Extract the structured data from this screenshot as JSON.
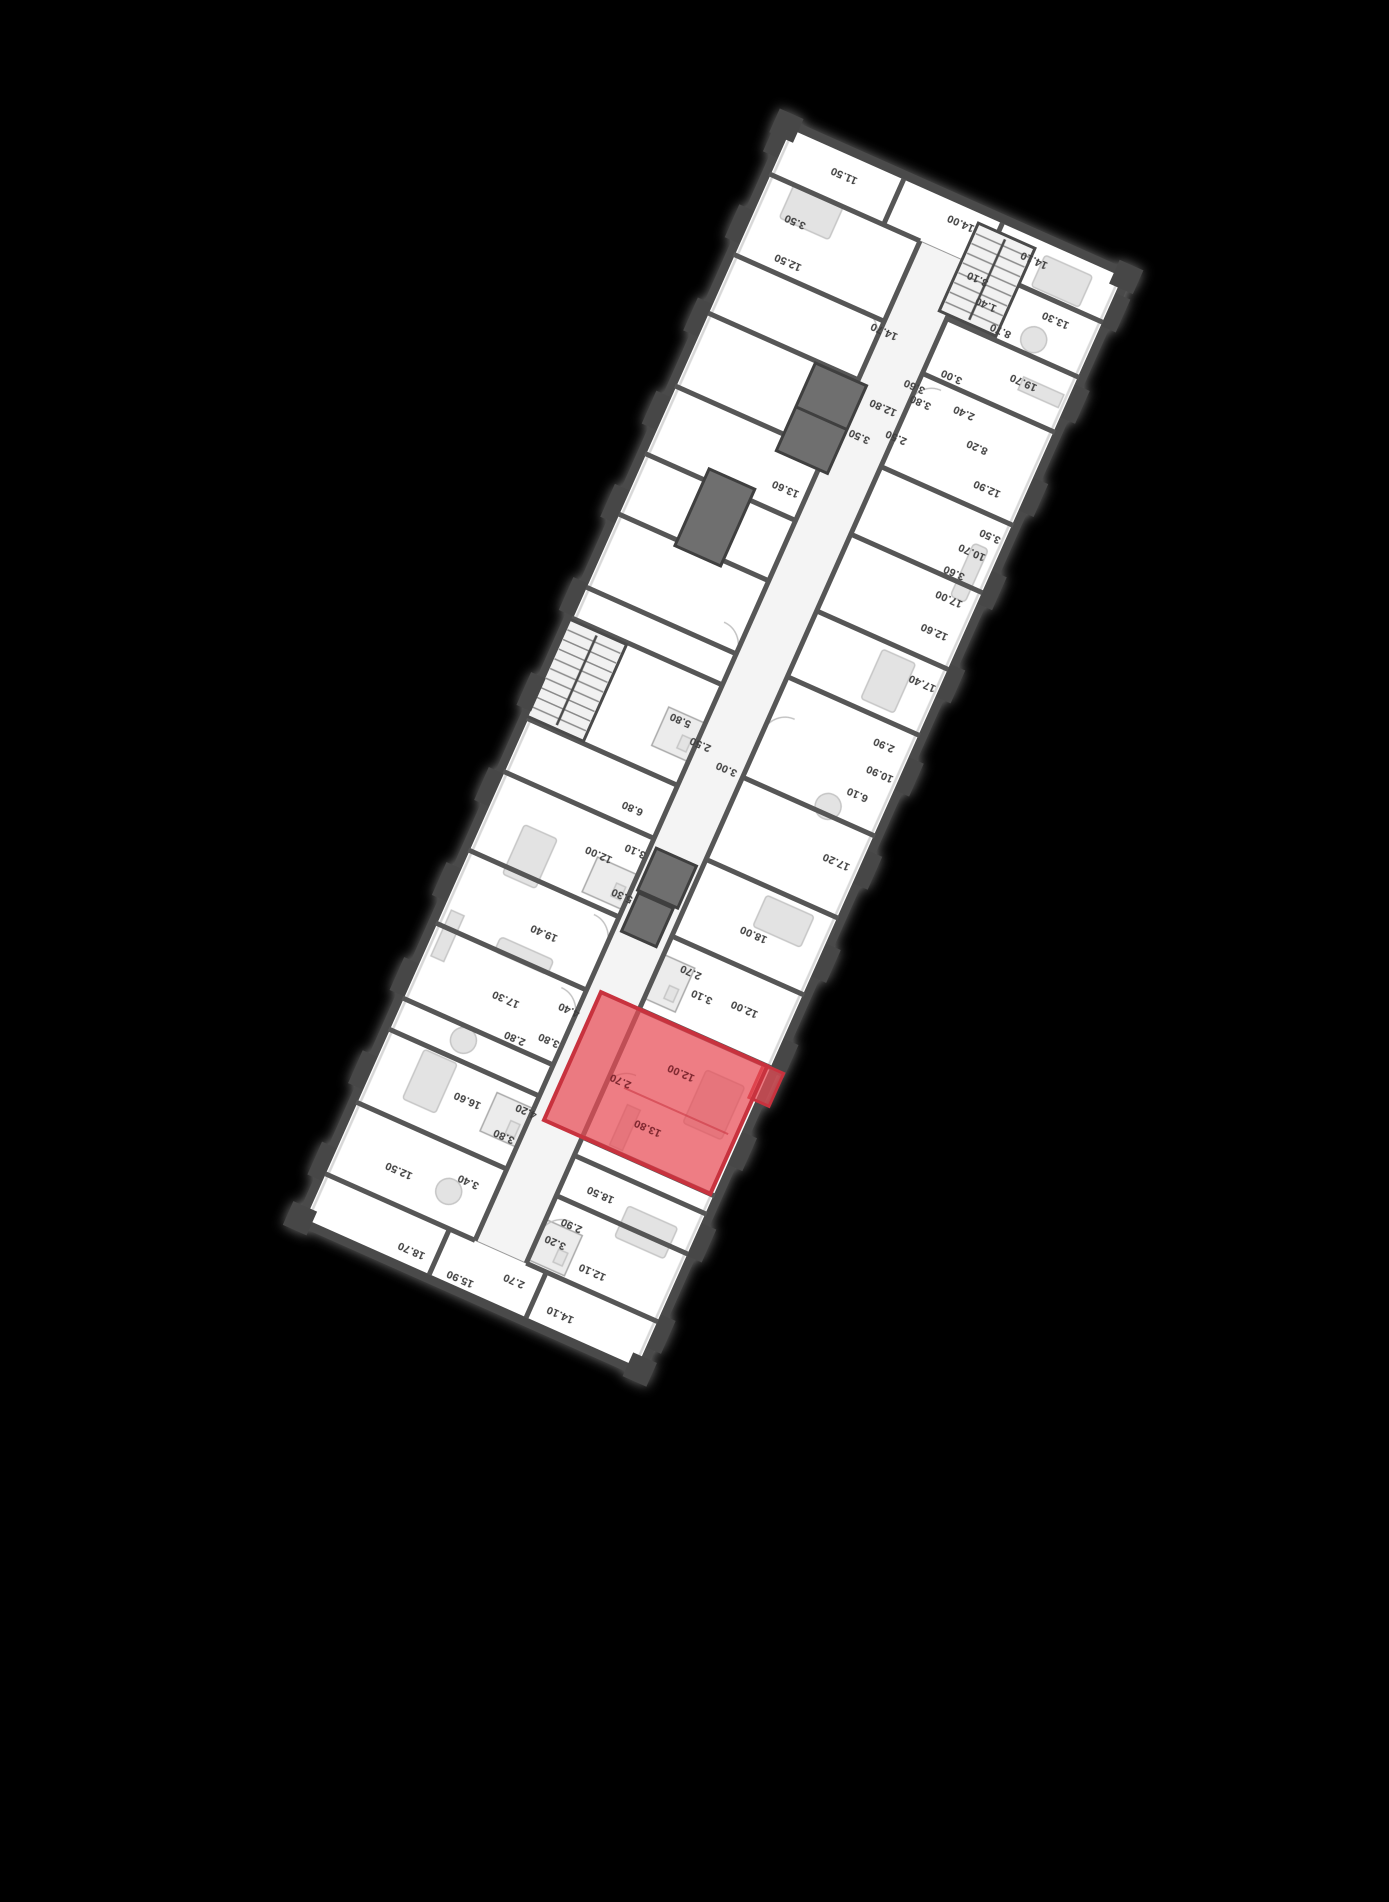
{
  "app": {
    "background": "#000000"
  },
  "floor_plan": {
    "rotation_deg": 204,
    "floor_color": "#ffffff",
    "corridor_color": "#f4f4f4",
    "wall_color": "#4a4a4a",
    "window_color": "#d8d8d8",
    "shaft_color": "#6f6f6f",
    "highlight": {
      "fill": "#e84b55",
      "fill_opacity": 0.72,
      "border": "#c8323e",
      "rect": {
        "x": 12,
        "y": 196,
        "w": 182,
        "h": 140
      },
      "tab": {
        "x": -6,
        "y": 300,
        "w": 22,
        "h": 36
      }
    },
    "geometry": {
      "outline": {
        "x": 4,
        "y": 4,
        "w": 372,
        "h": 1202
      },
      "corridor": {
        "x": 152,
        "y": 58,
        "w": 56,
        "h": 1094
      },
      "cross_walls_left": [
        58,
        132,
        176,
        196,
        336,
        416,
        500,
        590,
        700,
        772,
        856,
        930,
        1032,
        1092,
        1152
      ],
      "cross_walls_right": [
        58,
        136,
        216,
        250,
        332,
        412,
        498,
        556,
        666,
        700,
        780,
        846,
        920,
        1000,
        1064,
        1152
      ],
      "tip_walls": [
        {
          "x": 130,
          "y1": 8,
          "y2": 58
        },
        {
          "x": 236,
          "y1": 8,
          "y2": 58
        },
        {
          "x": 140,
          "y1": 1152,
          "y2": 1202
        },
        {
          "x": 248,
          "y1": 1152,
          "y2": 1202
        }
      ],
      "shafts": [
        [
          198,
          902,
          56,
          96
        ],
        [
          258,
          774,
          50,
          84
        ],
        [
          158,
          444,
          44,
          46
        ],
        [
          162,
          400,
          38,
          42
        ]
      ],
      "wet_rooms": [
        [
          118,
          348,
          34,
          48
        ],
        [
          112,
          62,
          40,
          44
        ],
        [
          208,
          582,
          40,
          42
        ],
        [
          208,
          420,
          44,
          38
        ],
        [
          120,
          1092,
          32,
          54
        ],
        [
          208,
          160,
          40,
          42
        ]
      ],
      "stairs": [
        {
          "x": 100,
          "y": 1096,
          "w": 62,
          "h": 96,
          "steps": 9
        },
        {
          "x": 312,
          "y": 558,
          "w": 62,
          "h": 106,
          "steps": 10
        }
      ],
      "piers_left": [
        30,
        130,
        230,
        332,
        436,
        538,
        640,
        742,
        844,
        946,
        1048,
        1148
      ],
      "piers_right": [
        50,
        150,
        252,
        356,
        460,
        564,
        668,
        770,
        872,
        974,
        1076,
        1170
      ]
    },
    "labels": [
      {
        "t": "14.10",
        "x": 100,
        "y": 28
      },
      {
        "t": "15.90",
        "x": 206,
        "y": 20
      },
      {
        "t": "18.70",
        "x": 262,
        "y": 26
      },
      {
        "t": "2.70",
        "x": 156,
        "y": 40
      },
      {
        "t": "12.10",
        "x": 88,
        "y": 80
      },
      {
        "t": "3.20",
        "x": 134,
        "y": 92
      },
      {
        "t": "2.90",
        "x": 126,
        "y": 114
      },
      {
        "t": "12.50",
        "x": 306,
        "y": 94
      },
      {
        "t": "3.40",
        "x": 238,
        "y": 112
      },
      {
        "t": "18.50",
        "x": 112,
        "y": 154
      },
      {
        "t": "3.80",
        "x": 224,
        "y": 168
      },
      {
        "t": "16.60",
        "x": 272,
        "y": 186
      },
      {
        "t": "4.20",
        "x": 214,
        "y": 200
      },
      {
        "t": "13.80",
        "x": 96,
        "y": 234,
        "hl": true
      },
      {
        "t": "2.70",
        "x": 140,
        "y": 266,
        "hl": true
      },
      {
        "t": "12.00",
        "x": 88,
        "y": 298,
        "hl": true
      },
      {
        "t": "2.80",
        "x": 254,
        "y": 262
      },
      {
        "t": "3.80",
        "x": 222,
        "y": 274
      },
      {
        "t": "17.30",
        "x": 278,
        "y": 294
      },
      {
        "t": "4.40",
        "x": 216,
        "y": 310
      },
      {
        "t": "3.10",
        "x": 100,
        "y": 376
      },
      {
        "t": "2.70",
        "x": 120,
        "y": 394
      },
      {
        "t": "12.00",
        "x": 56,
        "y": 382
      },
      {
        "t": "19.40",
        "x": 270,
        "y": 370
      },
      {
        "t": "18.00",
        "x": 78,
        "y": 454
      },
      {
        "t": "5.30",
        "x": 214,
        "y": 436
      },
      {
        "t": "12.00",
        "x": 252,
        "y": 464
      },
      {
        "t": "3.10",
        "x": 220,
        "y": 482
      },
      {
        "t": "6.80",
        "x": 240,
        "y": 520
      },
      {
        "t": "17.20",
        "x": 32,
        "y": 554
      },
      {
        "t": "3.00",
        "x": 170,
        "y": 594
      },
      {
        "t": "2.50",
        "x": 204,
        "y": 606
      },
      {
        "t": "5.80",
        "x": 232,
        "y": 620
      },
      {
        "t": "6.10",
        "x": 40,
        "y": 624
      },
      {
        "t": "10.90",
        "x": 28,
        "y": 652
      },
      {
        "t": "2.90",
        "x": 36,
        "y": 680
      },
      {
        "t": "17.40",
        "x": 26,
        "y": 752
      },
      {
        "t": "12.60",
        "x": 36,
        "y": 804
      },
      {
        "t": "17.00",
        "x": 36,
        "y": 840
      },
      {
        "t": "3.60",
        "x": 42,
        "y": 866
      },
      {
        "t": "10.70",
        "x": 34,
        "y": 892
      },
      {
        "t": "3.50",
        "x": 24,
        "y": 914
      },
      {
        "t": "13.60",
        "x": 230,
        "y": 874
      },
      {
        "t": "3.50",
        "x": 184,
        "y": 952
      },
      {
        "t": "2.50",
        "x": 150,
        "y": 966
      },
      {
        "t": "12.80",
        "x": 174,
        "y": 988
      },
      {
        "t": "3.60",
        "x": 154,
        "y": 1020
      },
      {
        "t": "12.90",
        "x": 46,
        "y": 956
      },
      {
        "t": "8.20",
        "x": 72,
        "y": 990
      },
      {
        "t": "2.40",
        "x": 98,
        "y": 1016
      },
      {
        "t": "3.80",
        "x": 142,
        "y": 1008
      },
      {
        "t": "3.00",
        "x": 124,
        "y": 1044
      },
      {
        "t": "19.70",
        "x": 56,
        "y": 1068
      },
      {
        "t": "14.70",
        "x": 204,
        "y": 1058
      },
      {
        "t": "12.50",
        "x": 320,
        "y": 1082
      },
      {
        "t": "3.50",
        "x": 330,
        "y": 1122
      },
      {
        "t": "8.70",
        "x": 98,
        "y": 1106
      },
      {
        "t": "1.40",
        "x": 122,
        "y": 1124
      },
      {
        "t": "3.10",
        "x": 140,
        "y": 1144
      },
      {
        "t": "13.30",
        "x": 52,
        "y": 1138
      },
      {
        "t": "14.10",
        "x": 96,
        "y": 1184
      },
      {
        "t": "14.00",
        "x": 178,
        "y": 1188
      },
      {
        "t": "11.50",
        "x": 304,
        "y": 1184
      }
    ]
  }
}
